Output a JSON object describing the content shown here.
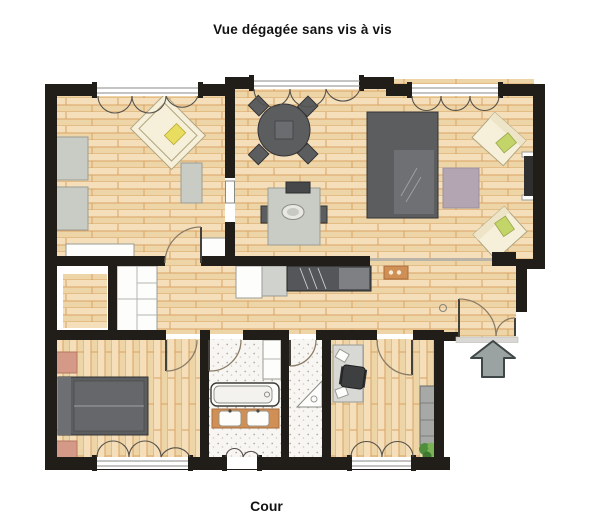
{
  "header": {
    "title": "Vue dégagée sans vis à vis"
  },
  "footer": {
    "label": "Cour"
  },
  "plan": {
    "kind": "apartment floor plan, top-down view",
    "entrance_icon": "up-arrow",
    "colors": {
      "wall": "#211d18",
      "wood1": "#f4dfba",
      "wood2": "#eed5a8",
      "woodline": "#d9a263",
      "tilebg": "#f8f6f3",
      "tiledot": "#b3ada3",
      "dark": "#5b5d5f",
      "darkline": "#333436",
      "light": "#c9cbc5",
      "lightline": "#9a9c96",
      "cream": "#f6efda",
      "creamline": "#b0a67f",
      "green": "#c3d468",
      "yellow": "#e8dd5e",
      "vanity": "#d08f55",
      "vanityline": "#a96e3f",
      "pink": "#d49a87",
      "pinkline": "#b57762",
      "rug": "#b4a5b3",
      "plant1": "#4f8f3b",
      "plant2": "#7ab356",
      "arrow": "#9ba3a2",
      "arrowline": "#3e4647",
      "door": "#8a7c66",
      "whitef": "#fdfdfc",
      "threshold": "#d9d8d4"
    }
  }
}
